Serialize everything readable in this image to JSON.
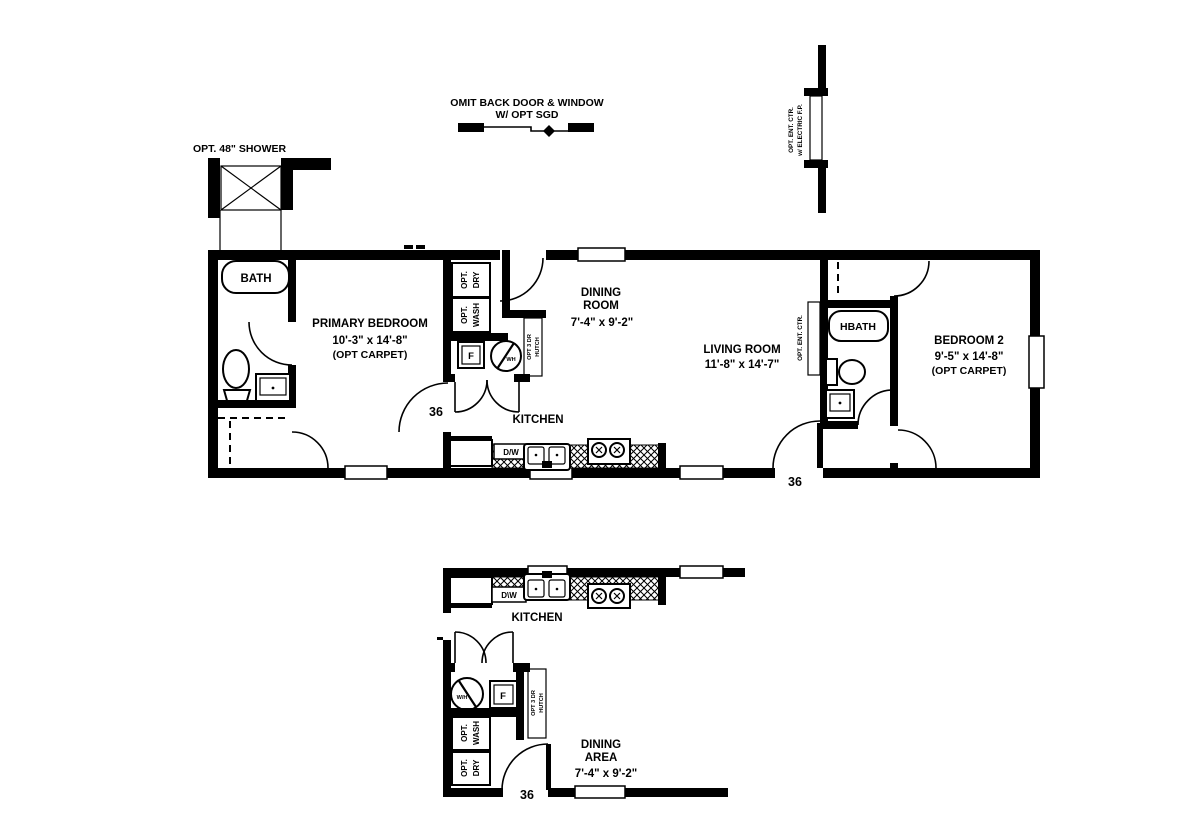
{
  "colors": {
    "ink": "#000000",
    "bg": "#ffffff"
  },
  "annotations": {
    "omit_back_door_line1": "OMIT BACK DOOR & WINDOW",
    "omit_back_door_line2": "W/ OPT SGD",
    "opt_shower": "OPT. 48\" SHOWER",
    "fireplace_line1": "OPT. ENT. CTR.",
    "fireplace_line2": "w/ ELECTRIC F.P.",
    "opt_ent_ctr_wall": "OPT. ENT. CTR."
  },
  "main_plan": {
    "bath": {
      "label": "BATH"
    },
    "primary_bedroom": {
      "name": "PRIMARY BEDROOM",
      "dims": "10'-3\" x  14'-8\"",
      "note": "(OPT CARPET)",
      "door_size": "36"
    },
    "utility": {
      "opt_dry_lines": [
        "OPT.",
        "DRY"
      ],
      "opt_wash_lines": [
        "OPT.",
        "WASH"
      ],
      "furnace": "F",
      "water_heater": "WH",
      "hutch_lines": [
        "OPT 3 DR",
        "HUTCH"
      ]
    },
    "dining_room": {
      "name_lines": [
        "DINING",
        "ROOM"
      ],
      "dims": "7'-4\" x  9'-2\""
    },
    "kitchen": {
      "label": "KITCHEN",
      "dishwasher": "D/W"
    },
    "living_room": {
      "name": "LIVING ROOM",
      "dims": "11'-8\" x  14'-7\"",
      "front_door_size": "36"
    },
    "hbath": {
      "label": "HBATH"
    },
    "bedroom2": {
      "name": "BEDROOM 2",
      "dims": "9'-5\" x  14'-8\"",
      "note": "(OPT CARPET)"
    }
  },
  "alt_layout": {
    "kitchen": {
      "label": "KITCHEN",
      "dishwasher": "D\\W"
    },
    "utility": {
      "water_heater": "W/H",
      "furnace": "F",
      "opt_wash_lines": [
        "OPT.",
        "WASH"
      ],
      "opt_dry_lines": [
        "OPT.",
        "DRY"
      ],
      "hutch_lines": [
        "OPT 3 DR",
        "HUTCH"
      ]
    },
    "dining_area": {
      "name_lines": [
        "DINING",
        "AREA"
      ],
      "dims": "7'-4\" x  9'-2\"",
      "door_size": "36"
    }
  }
}
